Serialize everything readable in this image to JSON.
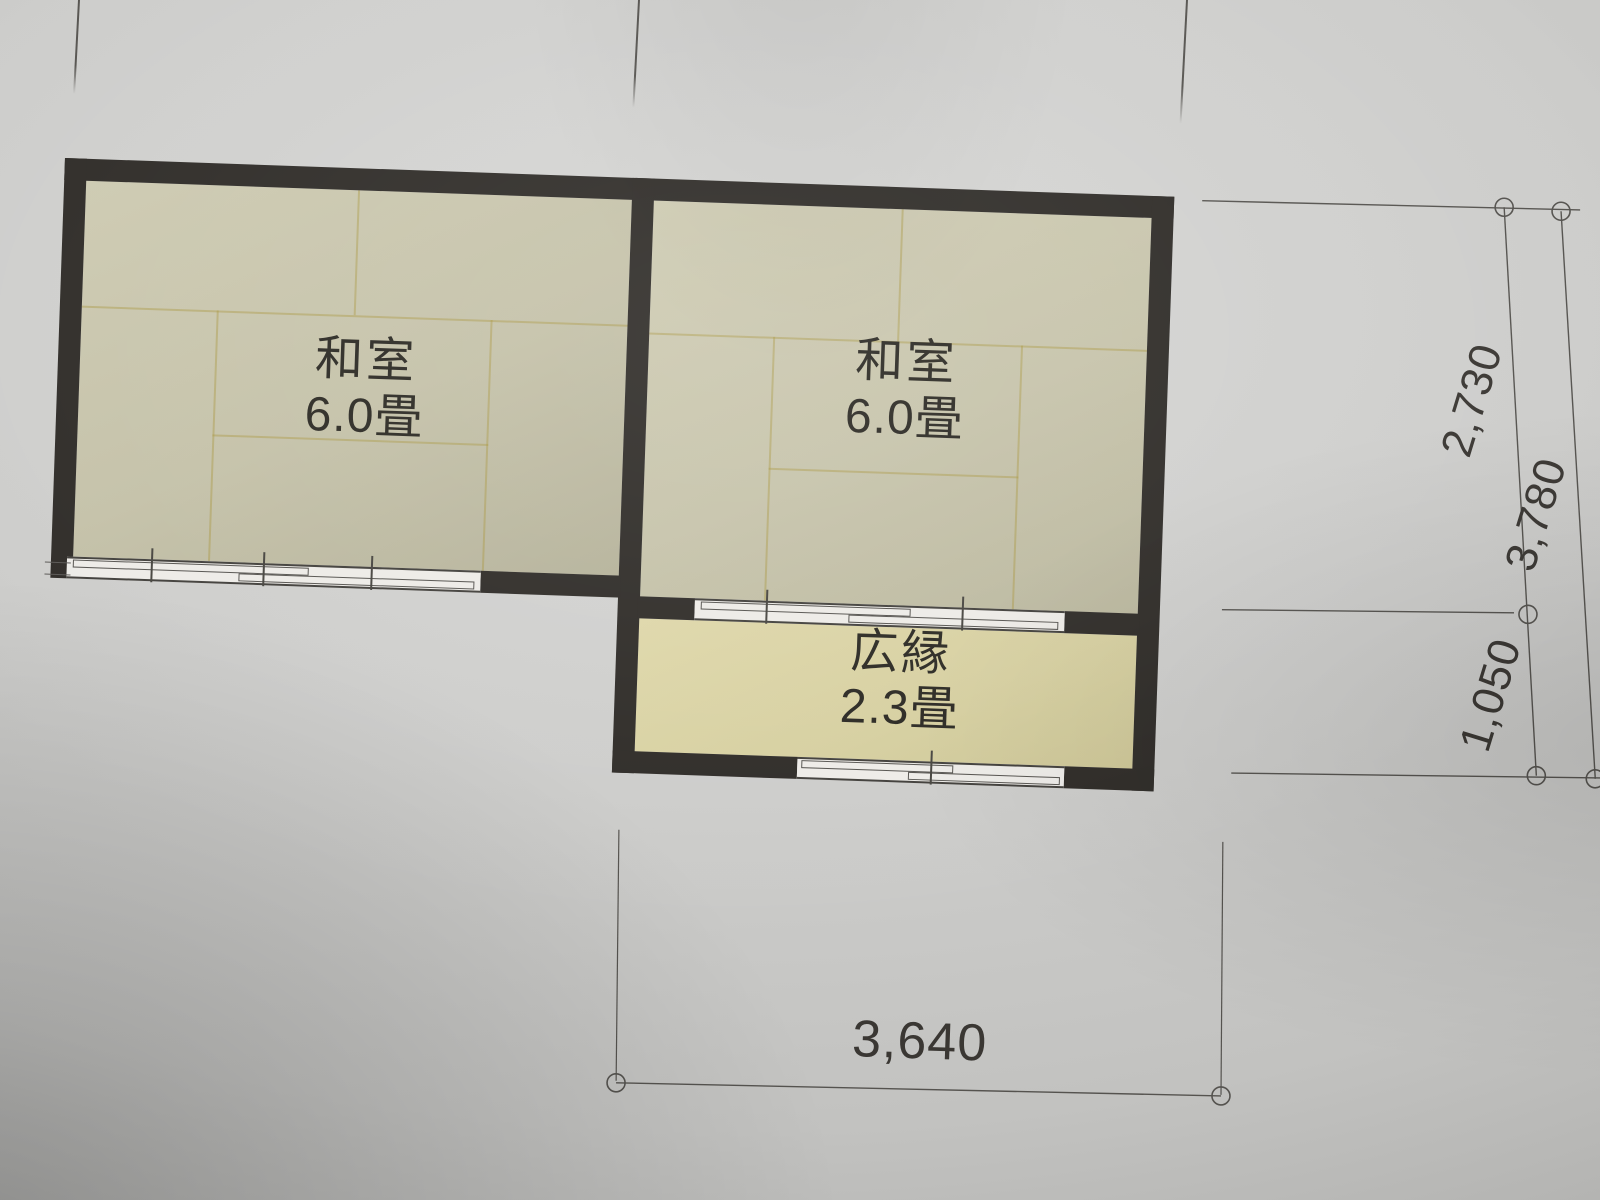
{
  "rooms": {
    "left": {
      "name": "和室",
      "size": "6.0畳"
    },
    "right": {
      "name": "和室",
      "size": "6.0畳"
    },
    "veranda": {
      "name": "広縁",
      "size": "2.3畳"
    }
  },
  "dimensions": {
    "room_height": "2,730",
    "veranda_height": "1,050",
    "total_height": "3,780",
    "bottom_width": "3,640"
  },
  "colors": {
    "paper": "#cbcbc9",
    "wall": "#2e2b27",
    "tatami_floor": "#c6c3aa",
    "tatami_seam": "#a89439",
    "veranda_floor": "#d6cfa0",
    "window_fill": "#edebe7",
    "dimension_line": "#55534f",
    "text": "#2a2822"
  }
}
